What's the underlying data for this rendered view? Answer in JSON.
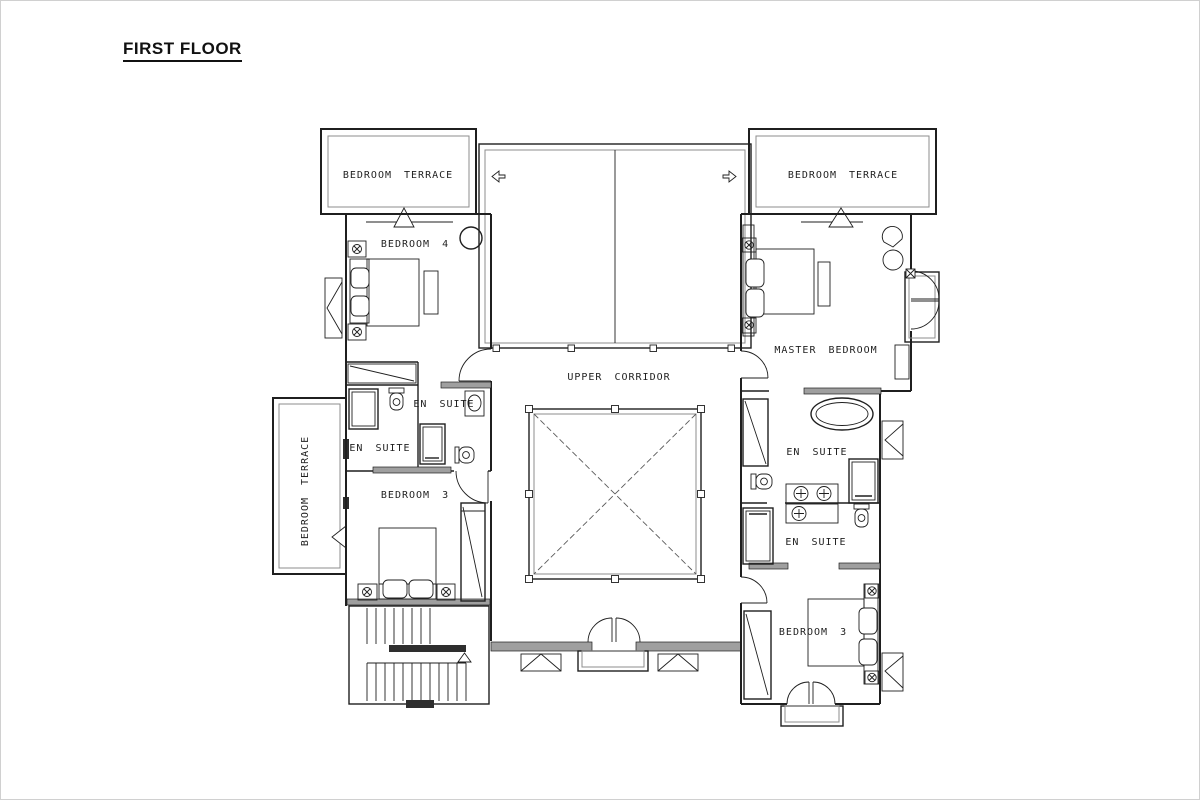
{
  "page": {
    "title": "FIRST FLOOR"
  },
  "plan": {
    "labels": {
      "terrace_top_left": "BEDROOM TERRACE",
      "terrace_top_right": "BEDROOM TERRACE",
      "terrace_side_left": "BEDROOM TERRACE",
      "bedroom_4": "BEDROOM 4",
      "en_suite_b4_inner": "EN SUITE",
      "en_suite_b4_outer": "EN SUITE",
      "bedroom_3_left": "BEDROOM 3",
      "upper_corridor": "UPPER CORRIDOR",
      "master_bedroom": "MASTER BEDROOM",
      "en_suite_master": "EN SUITE",
      "en_suite_b3_right": "EN SUITE",
      "bedroom_3_right": "BEDROOM 3"
    },
    "colors": {
      "ink": "#1f1f1f",
      "wall_fill": "#9f9f9f",
      "secondary_line": "#8c8c8c",
      "page_border": "#d0d0d0",
      "background": "#ffffff"
    }
  }
}
